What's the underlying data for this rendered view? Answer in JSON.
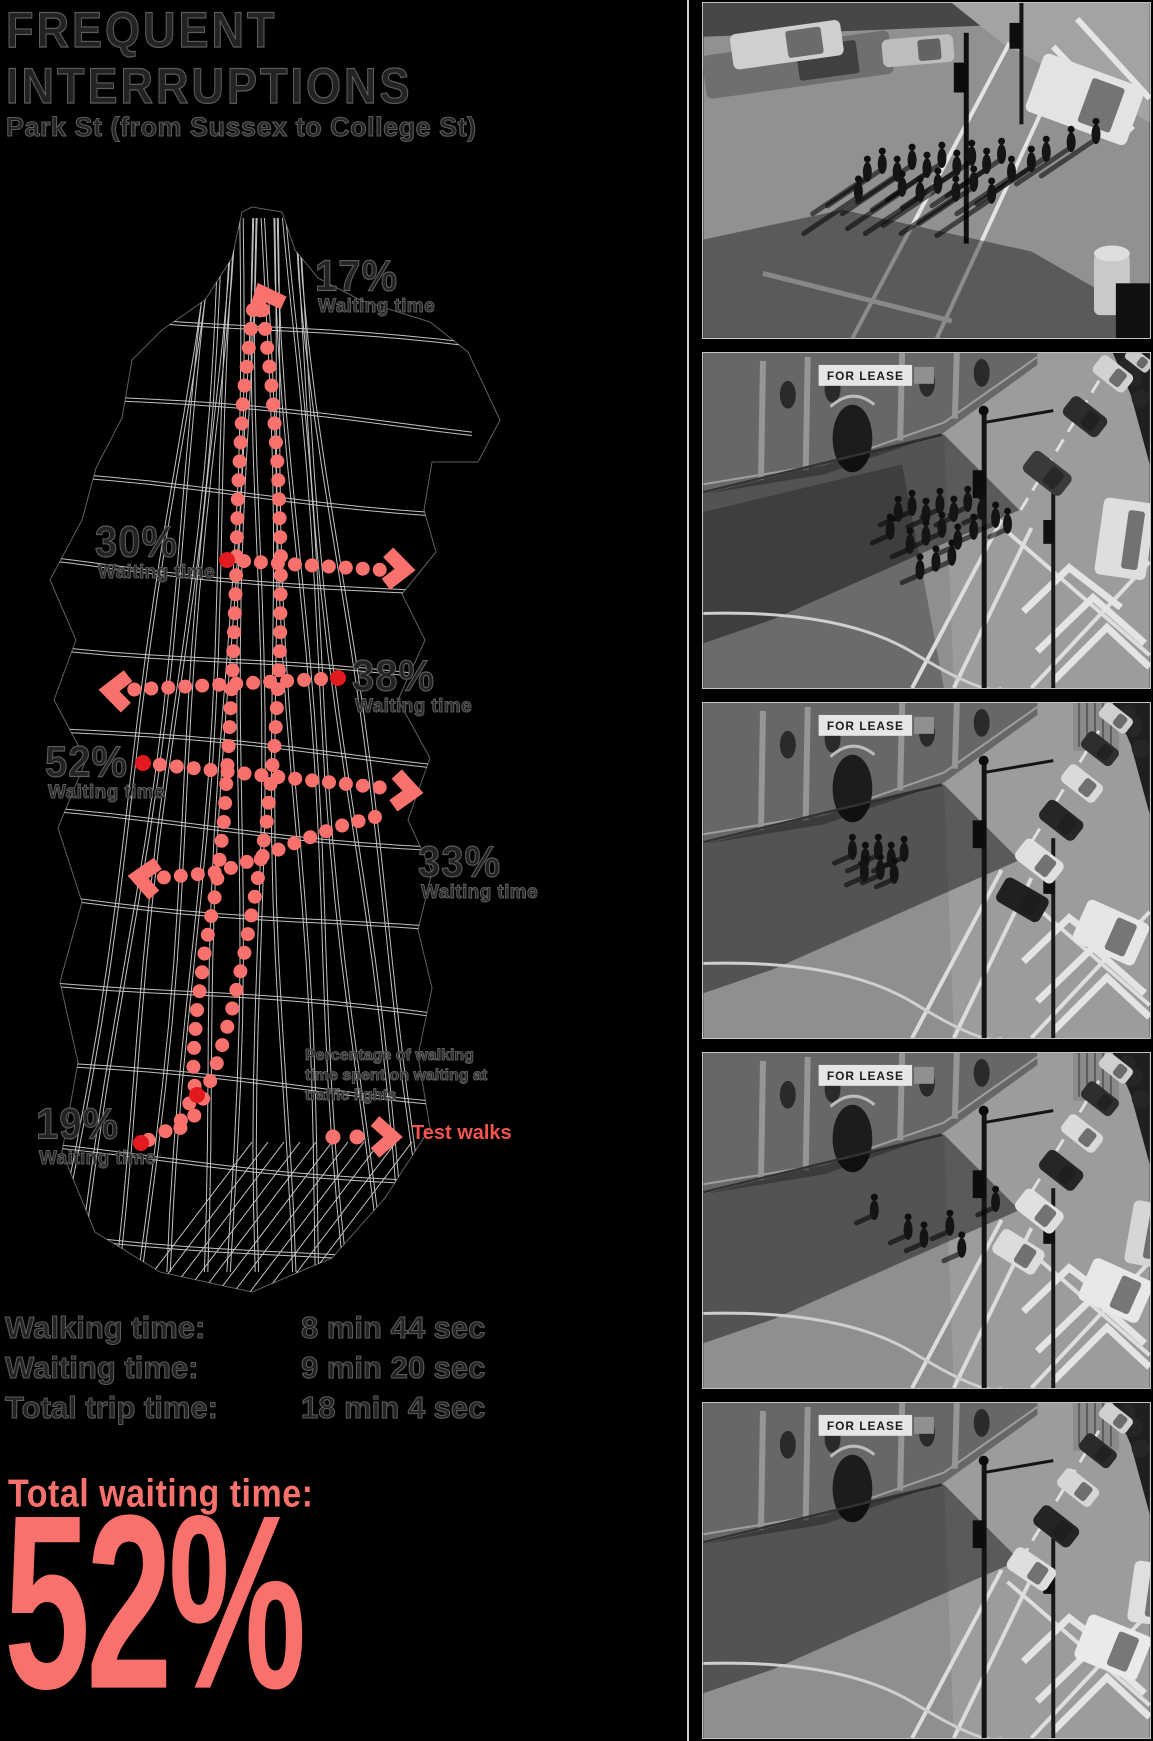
{
  "title": {
    "line1": "FREQUENT",
    "line2": "INTERRUPTIONS"
  },
  "subtitle": "Park St (from Sussex to College St)",
  "map": {
    "routes": [
      {
        "id": "route-17",
        "percent": "17%",
        "caption": "Waiting time"
      },
      {
        "id": "route-30",
        "percent": "30%",
        "caption": "Waiting time"
      },
      {
        "id": "route-38",
        "percent": "38%",
        "caption": "Waiting time"
      },
      {
        "id": "route-52",
        "percent": "52%",
        "caption": "Waiting time"
      },
      {
        "id": "route-33",
        "percent": "33%",
        "caption": "Waiting time"
      },
      {
        "id": "route-19",
        "percent": "19%",
        "caption": "Waiting time"
      }
    ],
    "legend": {
      "description": "Percentage of walking time spent on waiting at traffic lights",
      "test_walks_label": "Test walks"
    }
  },
  "stats": {
    "rows": [
      {
        "label": "Walking time:",
        "value": "8 min 44 sec"
      },
      {
        "label": "Waiting time:",
        "value": "9 min 20 sec"
      },
      {
        "label": "Total trip time:",
        "value": "18 min 4 sec"
      }
    ],
    "total_label": "Total waiting time:",
    "total_value": "52%"
  },
  "photos": [
    {
      "name": "photo-crowd-waiting-at-crossing",
      "sign": ""
    },
    {
      "name": "photo-pedestrians-crossing-for-lease-corner",
      "sign": "FOR LEASE"
    },
    {
      "name": "photo-corner-building-traffic-queue",
      "sign": "FOR LEASE"
    },
    {
      "name": "photo-intersection-cars-few-pedestrians",
      "sign": "FOR LEASE"
    },
    {
      "name": "photo-intersection-empty-crossing",
      "sign": "FOR LEASE"
    }
  ],
  "colors": {
    "accent": "#f8716c",
    "accent_deep": "#e21a20",
    "test_walks": "#f4544e",
    "map_line": "#ededed"
  }
}
